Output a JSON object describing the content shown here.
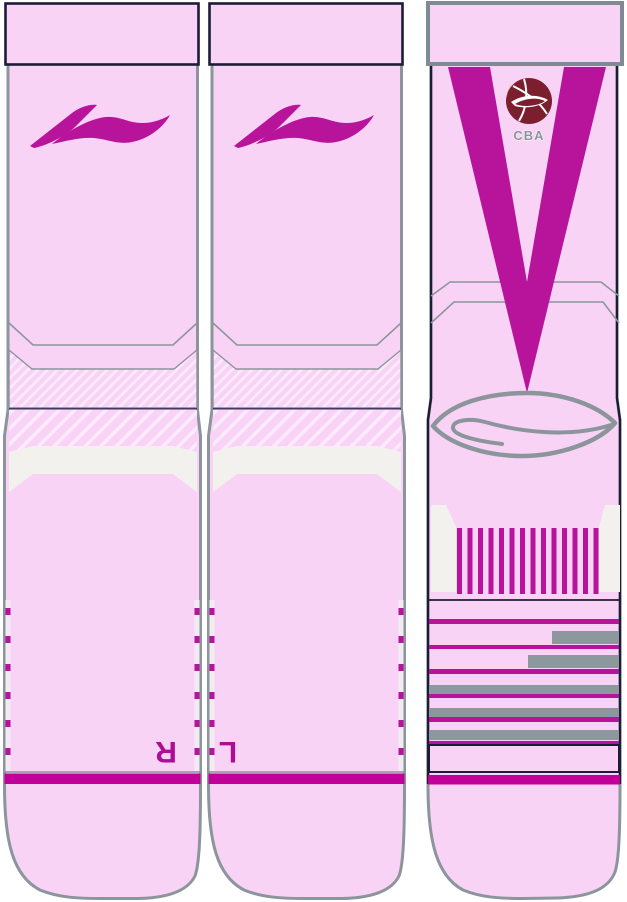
{
  "page": {
    "title": "Sock Design Mockup",
    "background_color": "#ffffff"
  },
  "colors": {
    "sock_pink": "#f8d3f6",
    "hatch_pink": "#fdeafc",
    "accent_magenta": "#b8139b",
    "band_magenta": "#c00098",
    "letter_magenta": "#ad0d90",
    "outline_gray": "#8c959b",
    "bar_gray": "#8d979e",
    "cuff_outline_navy": "#1c1c36",
    "seam_navy": "#3a3d60",
    "panel_white": "#f3f1ee",
    "cba_maroon": "#7b1f2e",
    "cba_gold": "#d9a41c",
    "cba_blue": "#1d4f9e"
  },
  "socks": {
    "a": {
      "view": "front view - right foot",
      "brand_icon": "li-ning-swoosh",
      "sole_letter": "R"
    },
    "b": {
      "view": "front view - left foot",
      "brand_icon": "li-ning-swoosh",
      "sole_letter": "L"
    },
    "c": {
      "view": "back view",
      "badge": {
        "icon": "cba-basketball",
        "label": "CBA"
      },
      "v_stripe": true,
      "heel_bar_count": 14
    }
  }
}
